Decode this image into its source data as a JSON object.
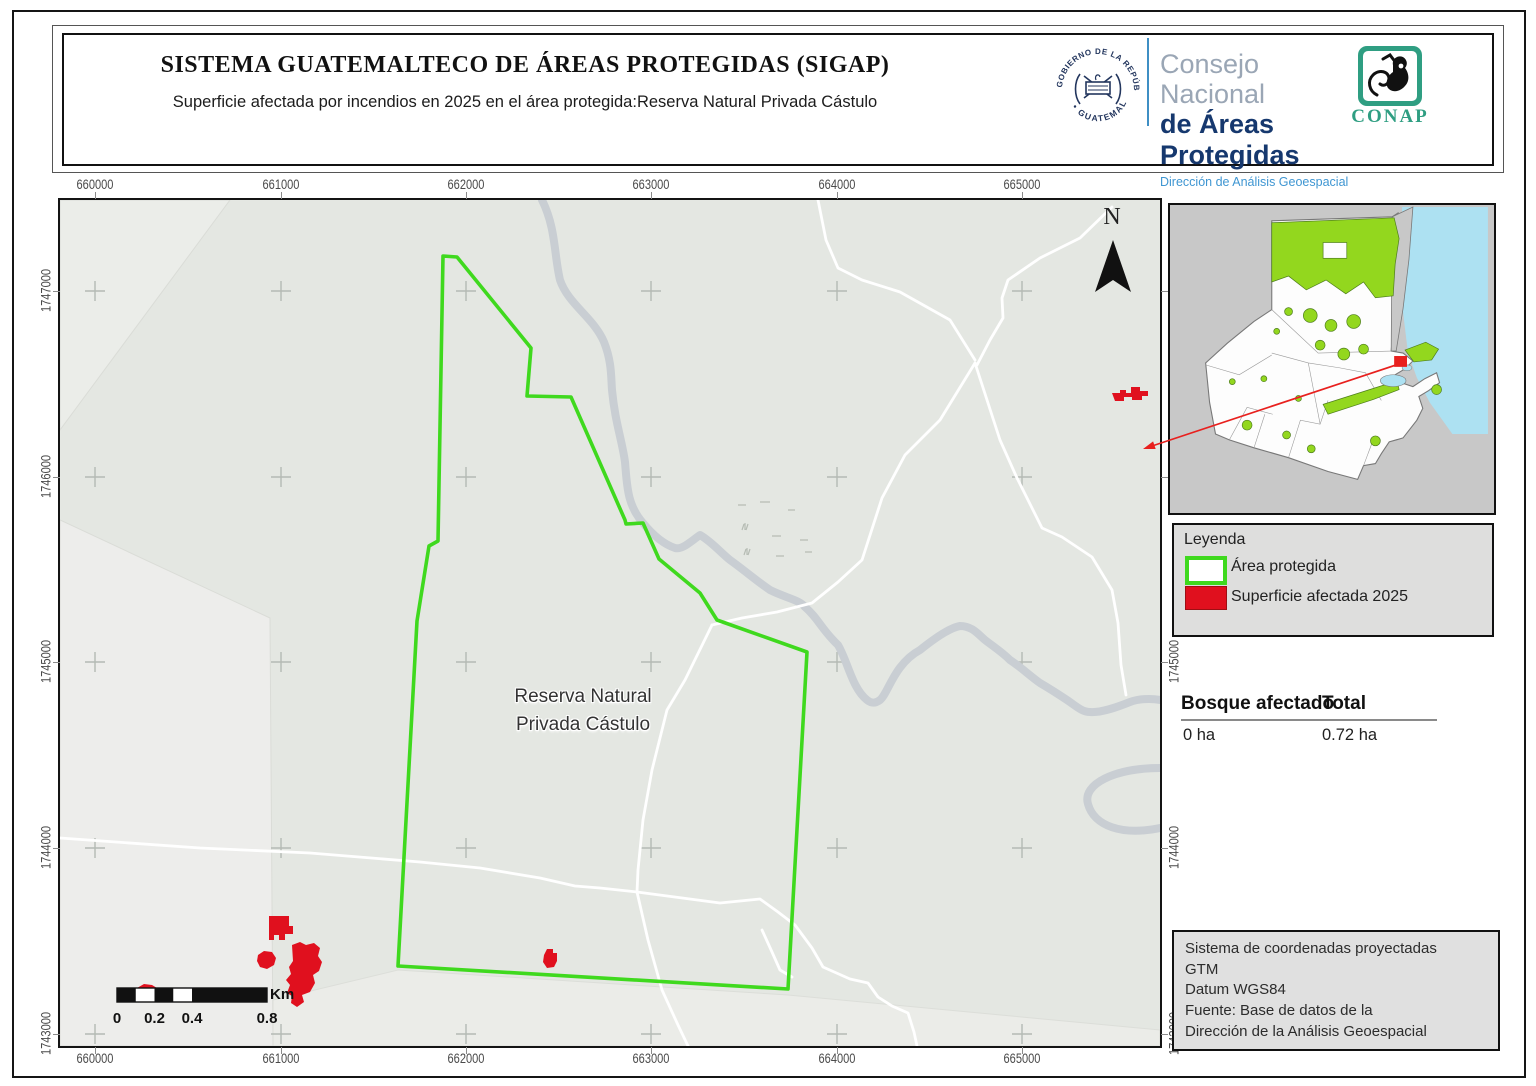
{
  "header": {
    "title": "SISTEMA GUATEMALTECO DE ÁREAS PROTEGIDAS  (SIGAP)",
    "subtitle": "Superficie afectada por incendios en 2025 en el área protegida:Reserva Natural Privada Cástulo",
    "seal_text_top": "GOBIERNO DE LA REPÚBLICA",
    "seal_text_bottom": "• GUATEMALA •",
    "consejo_line1": "Consejo Nacional",
    "consejo_line2": "de Áreas Protegidas",
    "consejo_line3": "Dirección de Análisis Geoespacial",
    "conap_label": "CONAP"
  },
  "map": {
    "reserve_label_line1": "Reserva Natural",
    "reserve_label_line2": "Privada Cástulo",
    "north_label": "N",
    "axes": {
      "x_labels": [
        "660000",
        "661000",
        "662000",
        "663000",
        "664000",
        "665000"
      ],
      "y_labels": [
        "1747000",
        "1746000",
        "1745000",
        "1744000",
        "1743000"
      ]
    },
    "scalebar": {
      "labels": [
        "0",
        "0.2",
        "0.4",
        "0.8"
      ],
      "unit": "Km"
    }
  },
  "legend": {
    "title": "Leyenda",
    "items": [
      {
        "label": "Área protegida",
        "swatch": "green-outline"
      },
      {
        "label": "Superficie afectada 2025",
        "swatch": "red-fill"
      }
    ]
  },
  "stats": {
    "col1_header": "Bosque afectado",
    "col2_header": "Total",
    "col1_value": "0 ha",
    "col2_value": "0.72 ha"
  },
  "info_box": {
    "lines": "Sistema de coordenadas proyectadas\nGTM\nDatum WGS84\nFuente: Base de datos de la\nDirección de la Análisis Geoespacial"
  },
  "colors": {
    "protected_outline": "#3fd91e",
    "fire_fill": "#e0101e",
    "river": "#c9ced3",
    "inset_protected": "#93d71e",
    "inset_water": "#ade1f2",
    "conap_green": "#2f9e82",
    "navy": "#23365e",
    "leader_red": "#e8201e"
  }
}
